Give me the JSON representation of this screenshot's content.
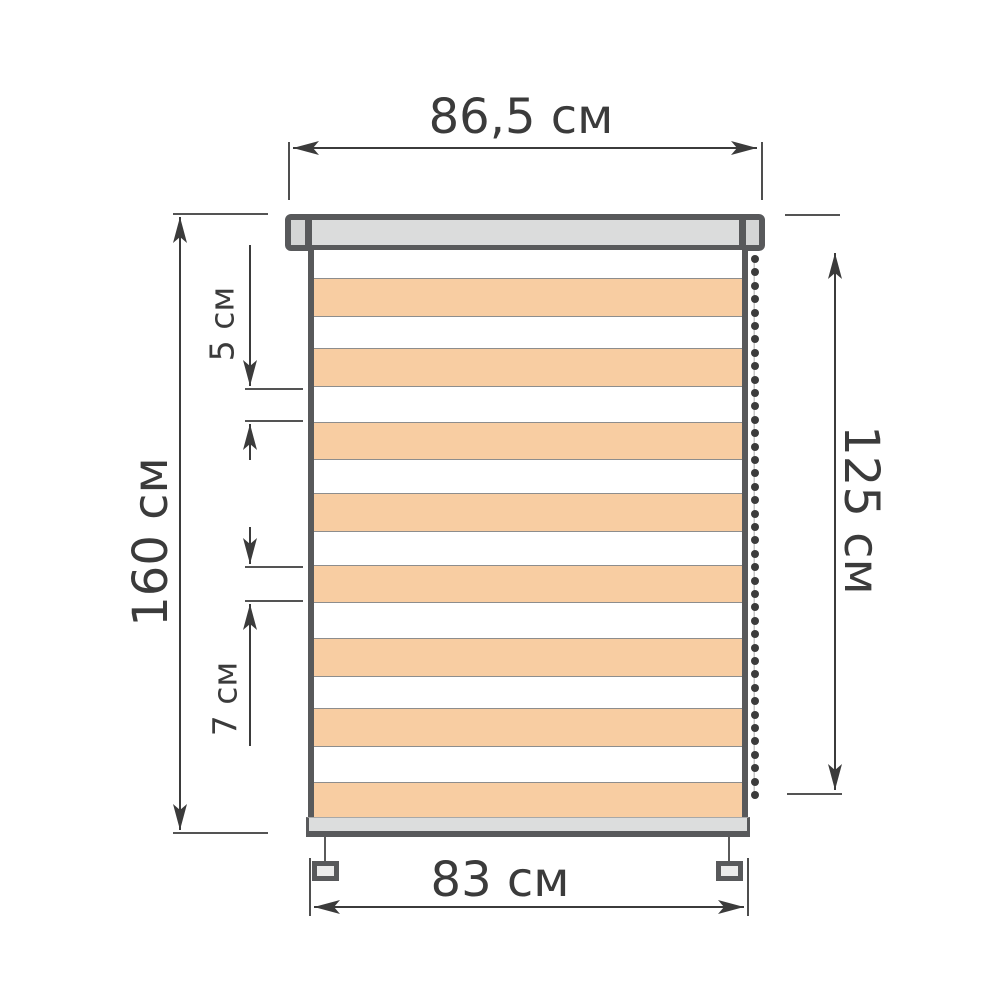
{
  "dimensions": {
    "top_width": "86,5 см",
    "total_height": "160 см",
    "fabric_height": "125 см",
    "fabric_width": "83 см",
    "light_stripe_height": "5 см",
    "dark_stripe_height": "7 см"
  },
  "blind": {
    "stripes": [
      {
        "c": "white",
        "h": 28
      },
      {
        "c": "orange",
        "h": 39
      },
      {
        "c": "white",
        "h": 31
      },
      {
        "c": "orange",
        "h": 39
      },
      {
        "c": "white",
        "h": 35
      },
      {
        "c": "orange",
        "h": 38
      },
      {
        "c": "white",
        "h": 33
      },
      {
        "c": "orange",
        "h": 39
      },
      {
        "c": "white",
        "h": 33
      },
      {
        "c": "orange",
        "h": 38
      },
      {
        "c": "white",
        "h": 35
      },
      {
        "c": "orange",
        "h": 39
      },
      {
        "c": "white",
        "h": 31
      },
      {
        "c": "orange",
        "h": 39
      },
      {
        "c": "white",
        "h": 35
      },
      {
        "c": "orange",
        "h": 38
      }
    ],
    "chain_bead_count": 41
  },
  "colors": {
    "ink": "#3b3b3b",
    "outline": "#58595b",
    "rail_fill": "#dbdcdc",
    "cap_fill": "#d4d5d5",
    "stripe_orange": "#f8cda2",
    "stripe_line": "#8d8d8d",
    "bar_fill": "#dcdddd",
    "clip_fill": "#ebebeb",
    "bead": "#3b3b3b"
  }
}
